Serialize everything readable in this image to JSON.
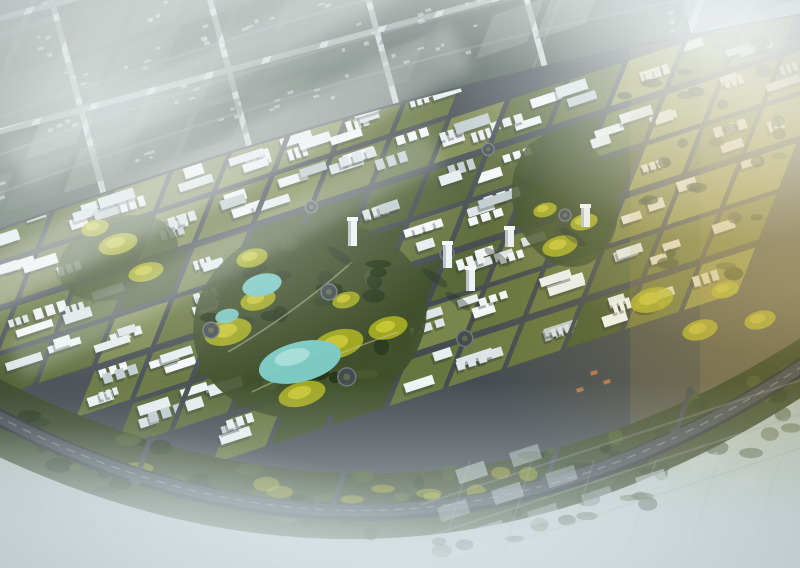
{
  "scene": {
    "title": "aerial-masterplan-render",
    "description": "Bird's-eye architectural rendering of a crescent-shaped planned city district: white mid-rise blocks on green courtyards, a central park with turquoise lakes and yellow-green trees, a dark arterial road above, a curved tree-lined ring highway below, districts fading into white fog at top-left and bottom, and warm golden sunlight on the right.",
    "elements": [
      "sky-haze",
      "distant-city-tiles",
      "distant-city-blocks",
      "upper-arterial-road",
      "city-band",
      "central-park",
      "lakes",
      "ring-highway",
      "greenbelt",
      "connector-roads",
      "foggy-suburbs",
      "sun-glow",
      "cloud-streaks"
    ]
  },
  "palette": {
    "sky_top": "#d6e0e2",
    "sky_mid": "#b9c6c2",
    "sky_low": "#a9b7ab",
    "sky_bottom": "#cbd8da",
    "road": "#454c51",
    "road_dark": "#2e3437",
    "road_line": "#9aa3a7",
    "block_greens": [
      "#5e6c3b",
      "#67753f",
      "#4f5f33",
      "#6e7b44",
      "#596839",
      "#79864b"
    ],
    "park_green": "#41502b",
    "building_whites": [
      "#e8eef0",
      "#eff4f5",
      "#dde5e8",
      "#f4f8f9"
    ],
    "building_shadow": "#2c3836",
    "roof_gray": "#c2cdd1",
    "tower_face": "#eef3f5",
    "tower_side": "#b9c4c8",
    "tower_top": "#f6fafa",
    "water": "#7cc9c4",
    "water_light": "#aee0da",
    "canopy": [
      "#2c3a20",
      "#35452a",
      "#243218",
      "#4a5a30"
    ],
    "yellow_tree": "#b8bd20",
    "yellow_tree_light": "#d6d23b",
    "golden_greens": [
      "#7f8443",
      "#8d9048",
      "#6e763c"
    ],
    "golden_slab": "#ebe6d4",
    "golden_wash": "#c8a94e",
    "orange_roof": "#c77b4a",
    "distant_tiles": [
      "#3f4d45",
      "#4a5850",
      "#36433c",
      "#56645b",
      "#61706b"
    ],
    "distant_blocks": [
      "#64726a",
      "#57655e",
      "#6f7d74",
      "#7b877e"
    ],
    "distant_dot": "#ccd6d8",
    "tile_grout": "#c8d4d4",
    "suburb_slab": "#c7d2d6",
    "suburb_slab_left": "#b4c2c8",
    "greenbelt": "#3c482c",
    "path_tan": "#c9c6a2",
    "fog_white": "#f2f6f6",
    "fog_bottom": "#d7e2e6",
    "haze_tr": "#f3f7f7",
    "golden_glow": "#d8b95e",
    "vignette": "#31404a",
    "ring_stroke": "#6f787b",
    "ring_center": "#5f6c52"
  },
  "render": {
    "width": 800,
    "height": 568,
    "seed": 7
  }
}
